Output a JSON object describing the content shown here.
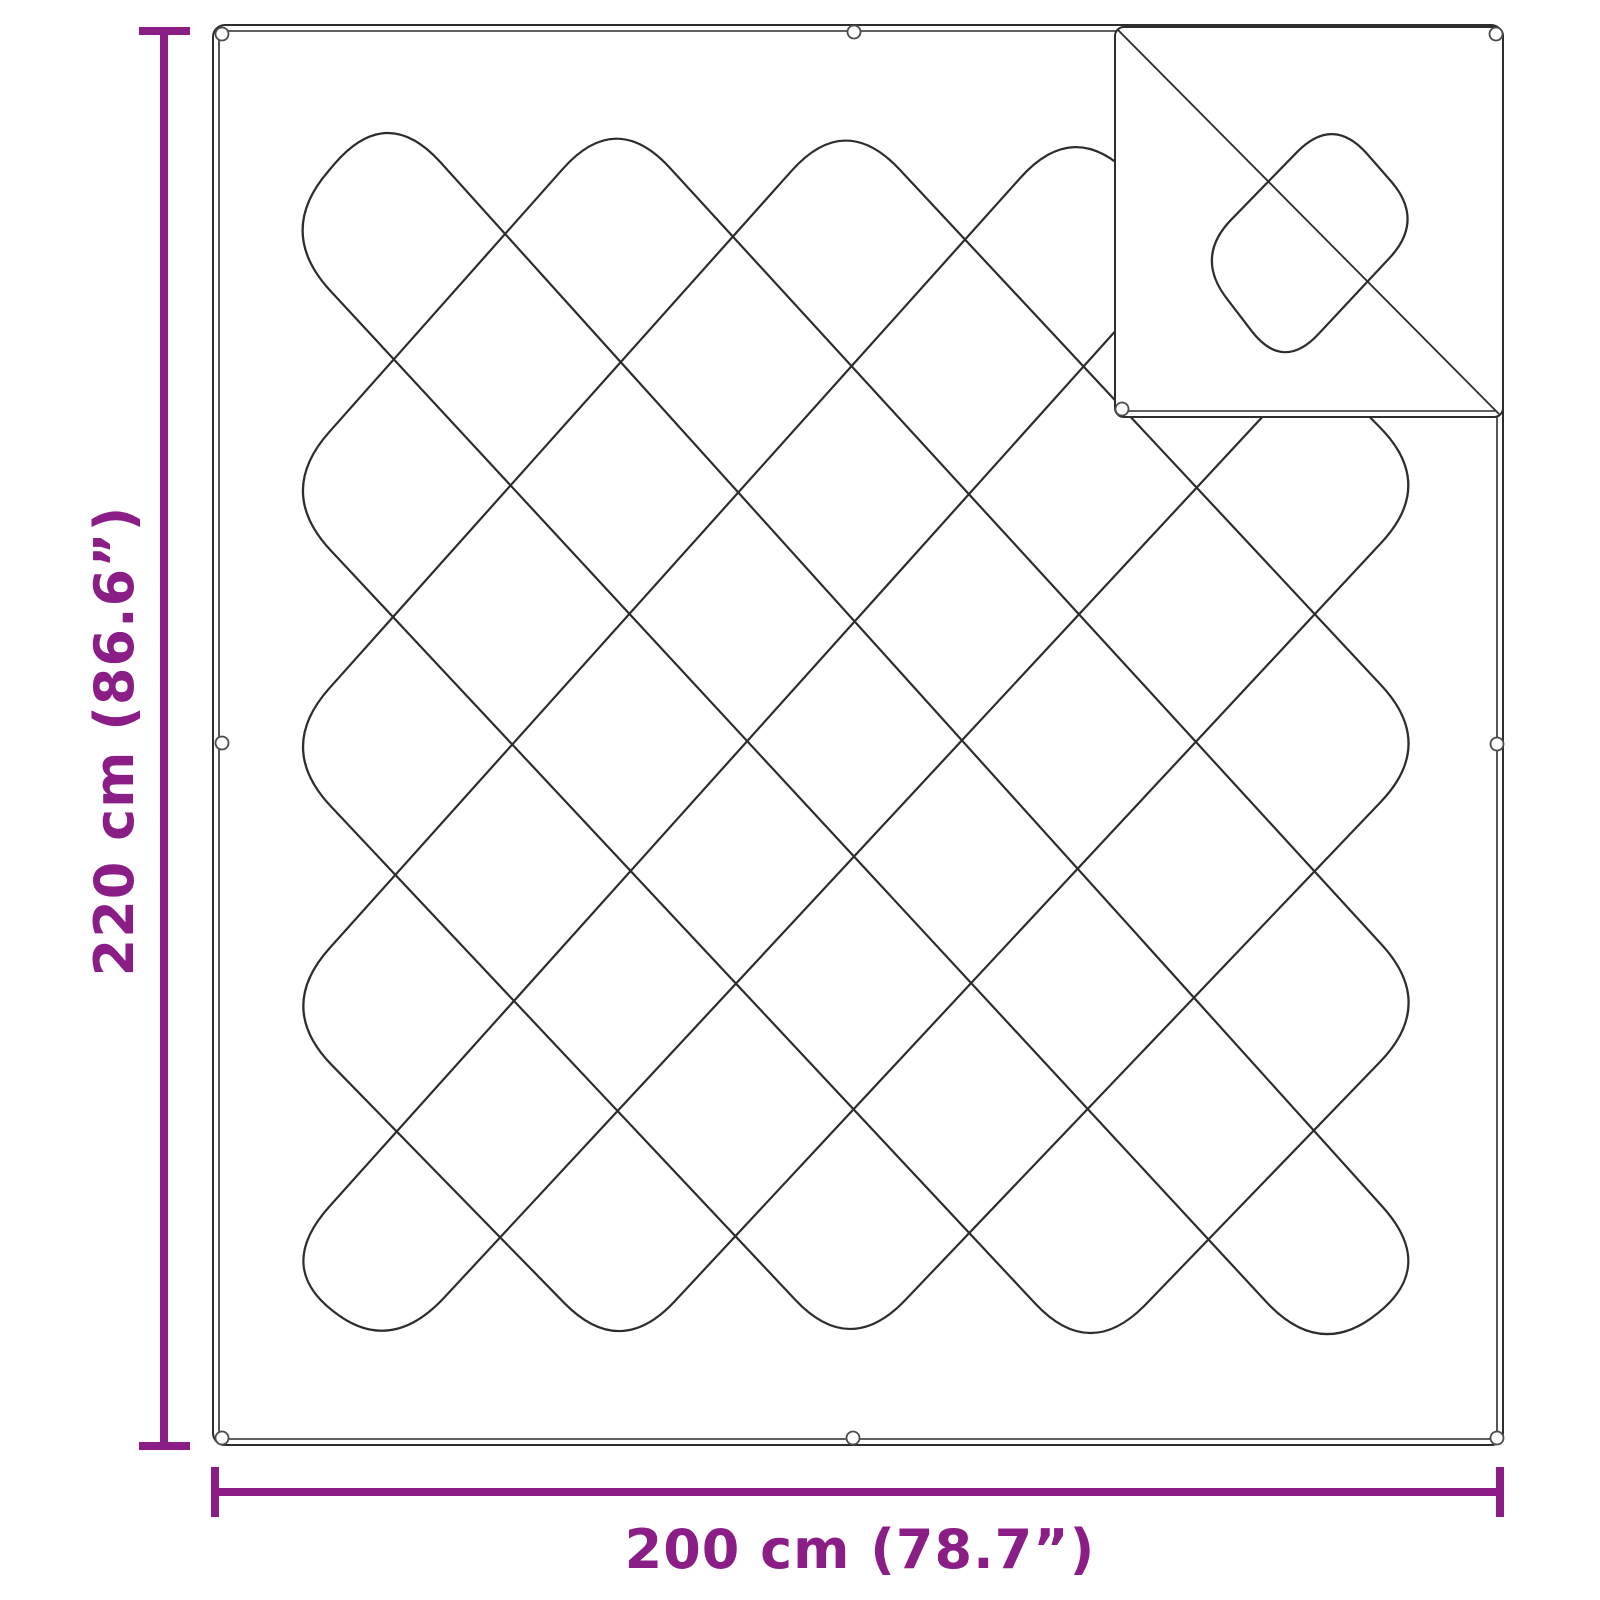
{
  "diagram": {
    "height_label": "220 cm (86.6”)",
    "width_label": "200 cm (78.7”)",
    "colors": {
      "accent": "#8b1d86",
      "line": "#2d2d2d",
      "eyelet_ring": "#4a4a4a",
      "background": "#ffffff"
    }
  }
}
